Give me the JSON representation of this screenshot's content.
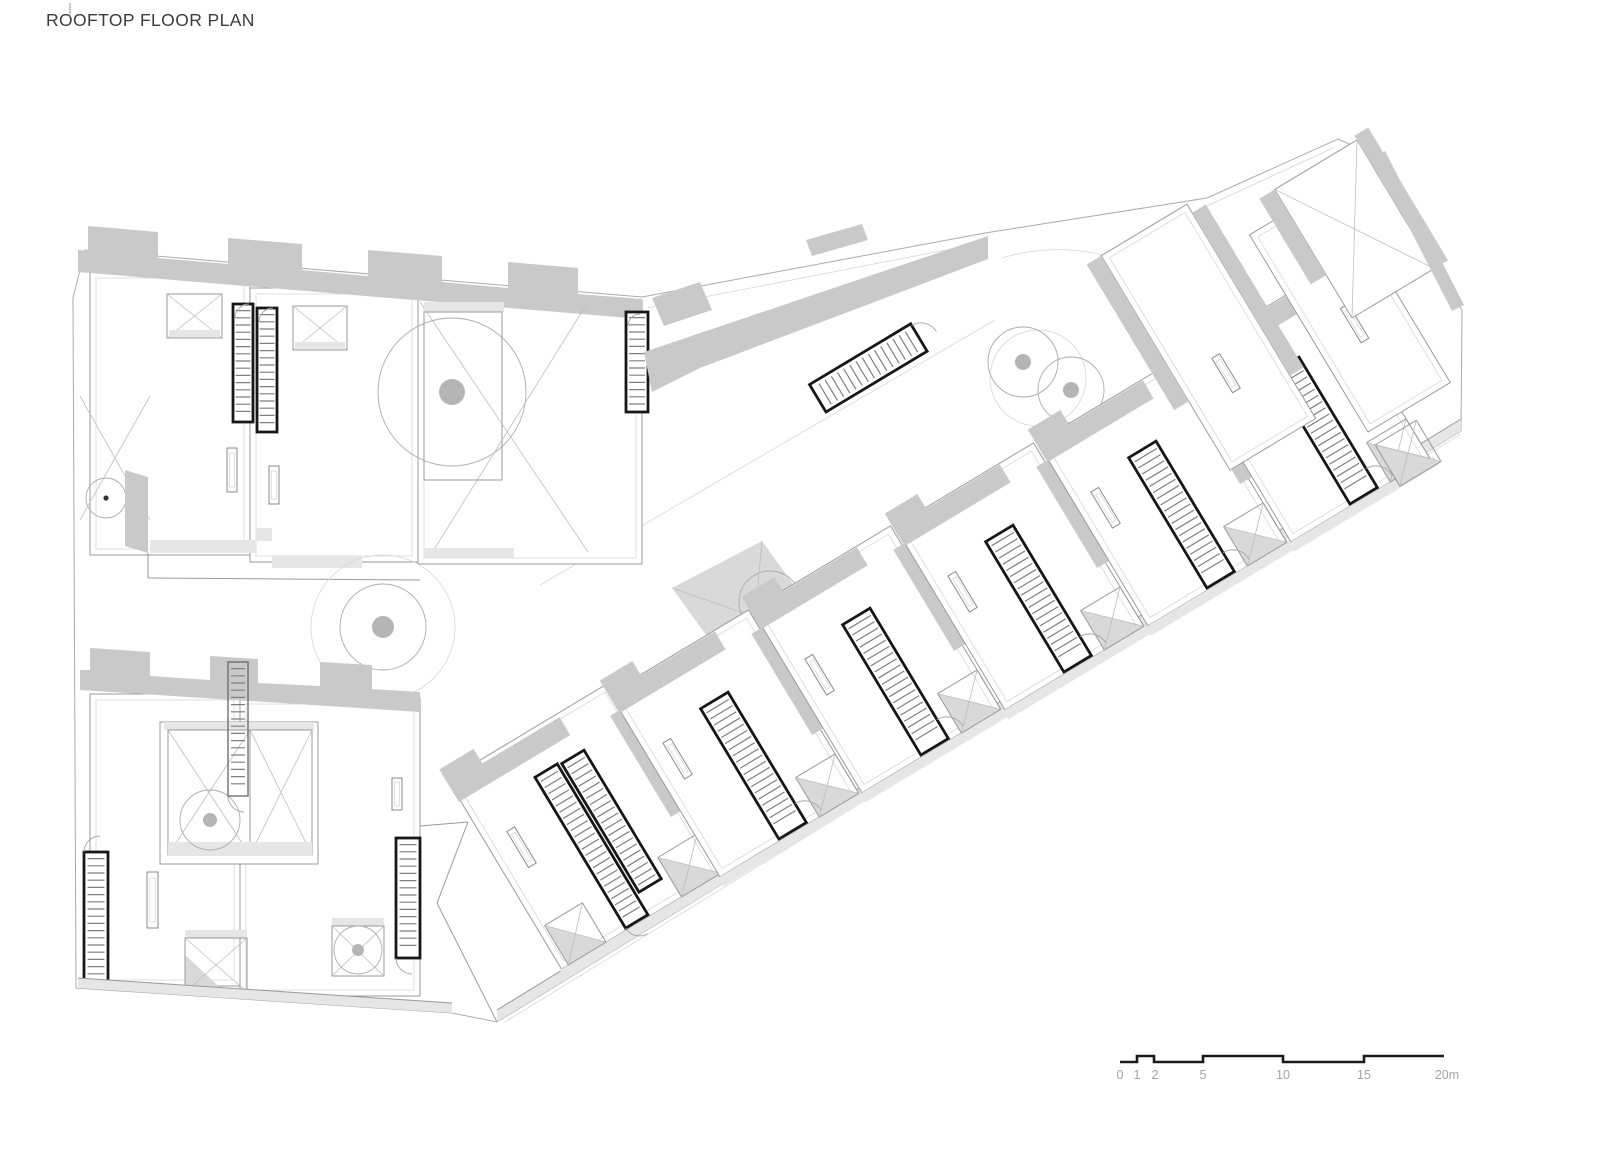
{
  "title": {
    "text": "ROOFTOP FLOOR PLAN"
  },
  "scale_bar": {
    "labels": [
      "0",
      "1",
      "2",
      "5",
      "10",
      "15",
      "20m"
    ]
  },
  "plan": {
    "kind": "architectural rooftop floor plan",
    "colors": {
      "wall_fill": "#c9c9c9",
      "terrace_fill": "#e6e6e6",
      "outline_line": "#9a9a9a",
      "stair_outline": "#171717",
      "scale_label_text": "#a3a3a3",
      "title_text": "#3c3c3c"
    }
  }
}
